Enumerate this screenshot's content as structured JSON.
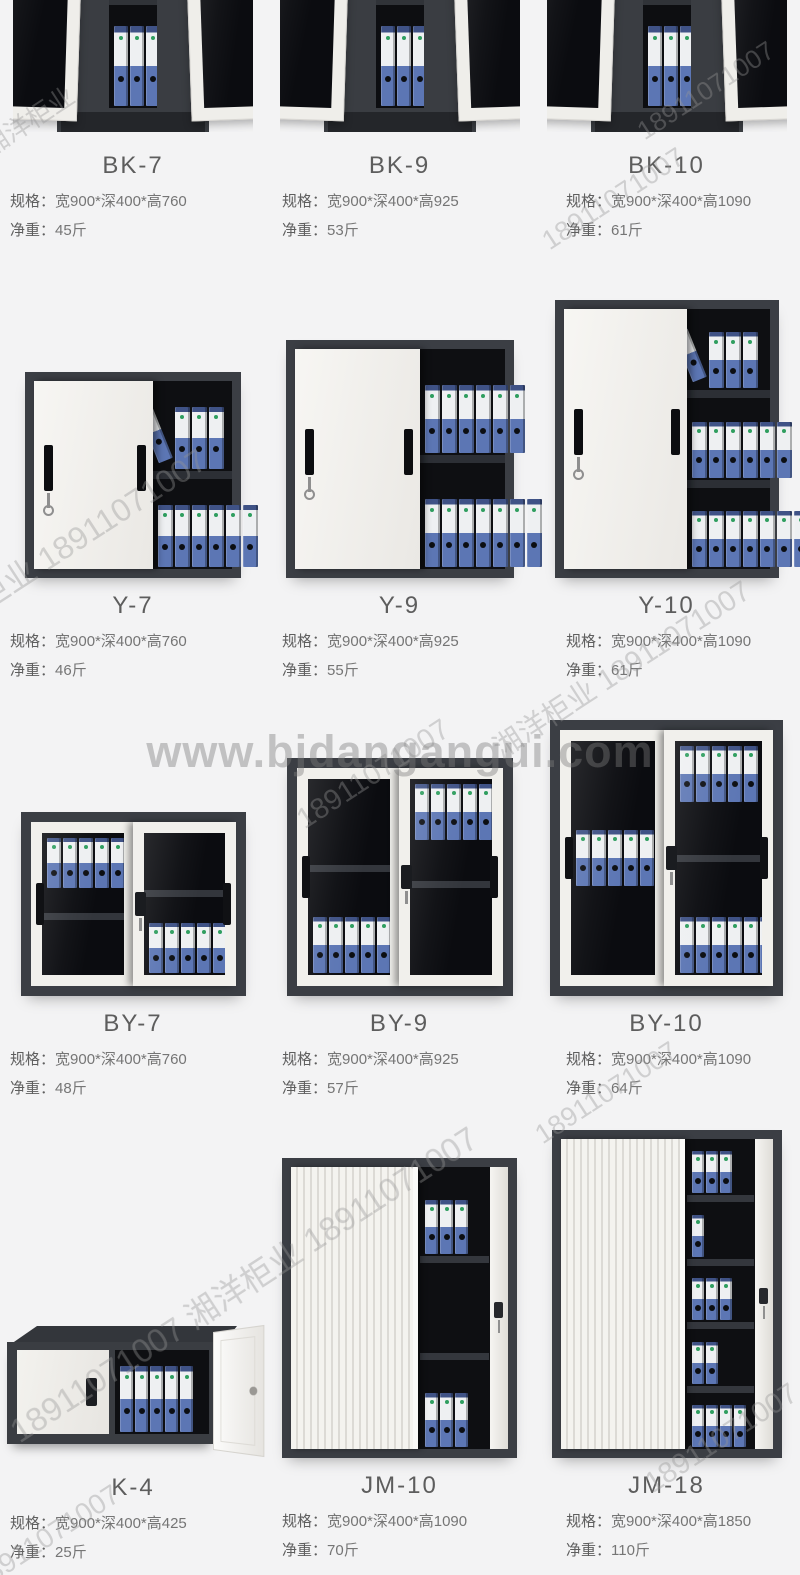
{
  "watermarks": {
    "center": "www.bjdangangui.com",
    "phone": "18911071007",
    "brand": "湘洋柜业",
    "brand_phone": "湘洋柜业 18911071007",
    "phone_brand_phone": "18911071007 湘洋柜业 18911071007"
  },
  "labels": {
    "spec": "规格：",
    "weight": "净重："
  },
  "products": [
    {
      "model": "BK-7",
      "spec": "宽900*深400*高760",
      "weight": "45斤"
    },
    {
      "model": "BK-9",
      "spec": "宽900*深400*高925",
      "weight": "53斤"
    },
    {
      "model": "BK-10",
      "spec": "宽900*深400*高1090",
      "weight": "61斤"
    },
    {
      "model": "Y-7",
      "spec": "宽900*深400*高760",
      "weight": "46斤"
    },
    {
      "model": "Y-9",
      "spec": "宽900*深400*高925",
      "weight": "55斤"
    },
    {
      "model": "Y-10",
      "spec": "宽900*深400*高1090",
      "weight": "61斤"
    },
    {
      "model": "BY-7",
      "spec": "宽900*深400*高760",
      "weight": "48斤"
    },
    {
      "model": "BY-9",
      "spec": "宽900*深400*高925",
      "weight": "57斤"
    },
    {
      "model": "BY-10",
      "spec": "宽900*深400*高1090",
      "weight": "64斤"
    },
    {
      "model": "K-4",
      "spec": "宽900*深400*高425",
      "weight": "25斤"
    },
    {
      "model": "JM-10",
      "spec": "宽900*深400*高1090",
      "weight": "70斤"
    },
    {
      "model": "JM-18",
      "spec": "宽900*深400*高1850",
      "weight": "110斤"
    }
  ],
  "colors": {
    "page_bg": "#f3f3f4",
    "cabinet_frame": "#3b3e44",
    "cabinet_interior": "#0e0f12",
    "door_white": "#f2f1ed",
    "binder_blue": "#5c76b4",
    "binder_label": "#eef0f2",
    "title_text": "#5d5d5d",
    "spec_text": "#757575",
    "watermark_gray": "#b5b5b5"
  }
}
